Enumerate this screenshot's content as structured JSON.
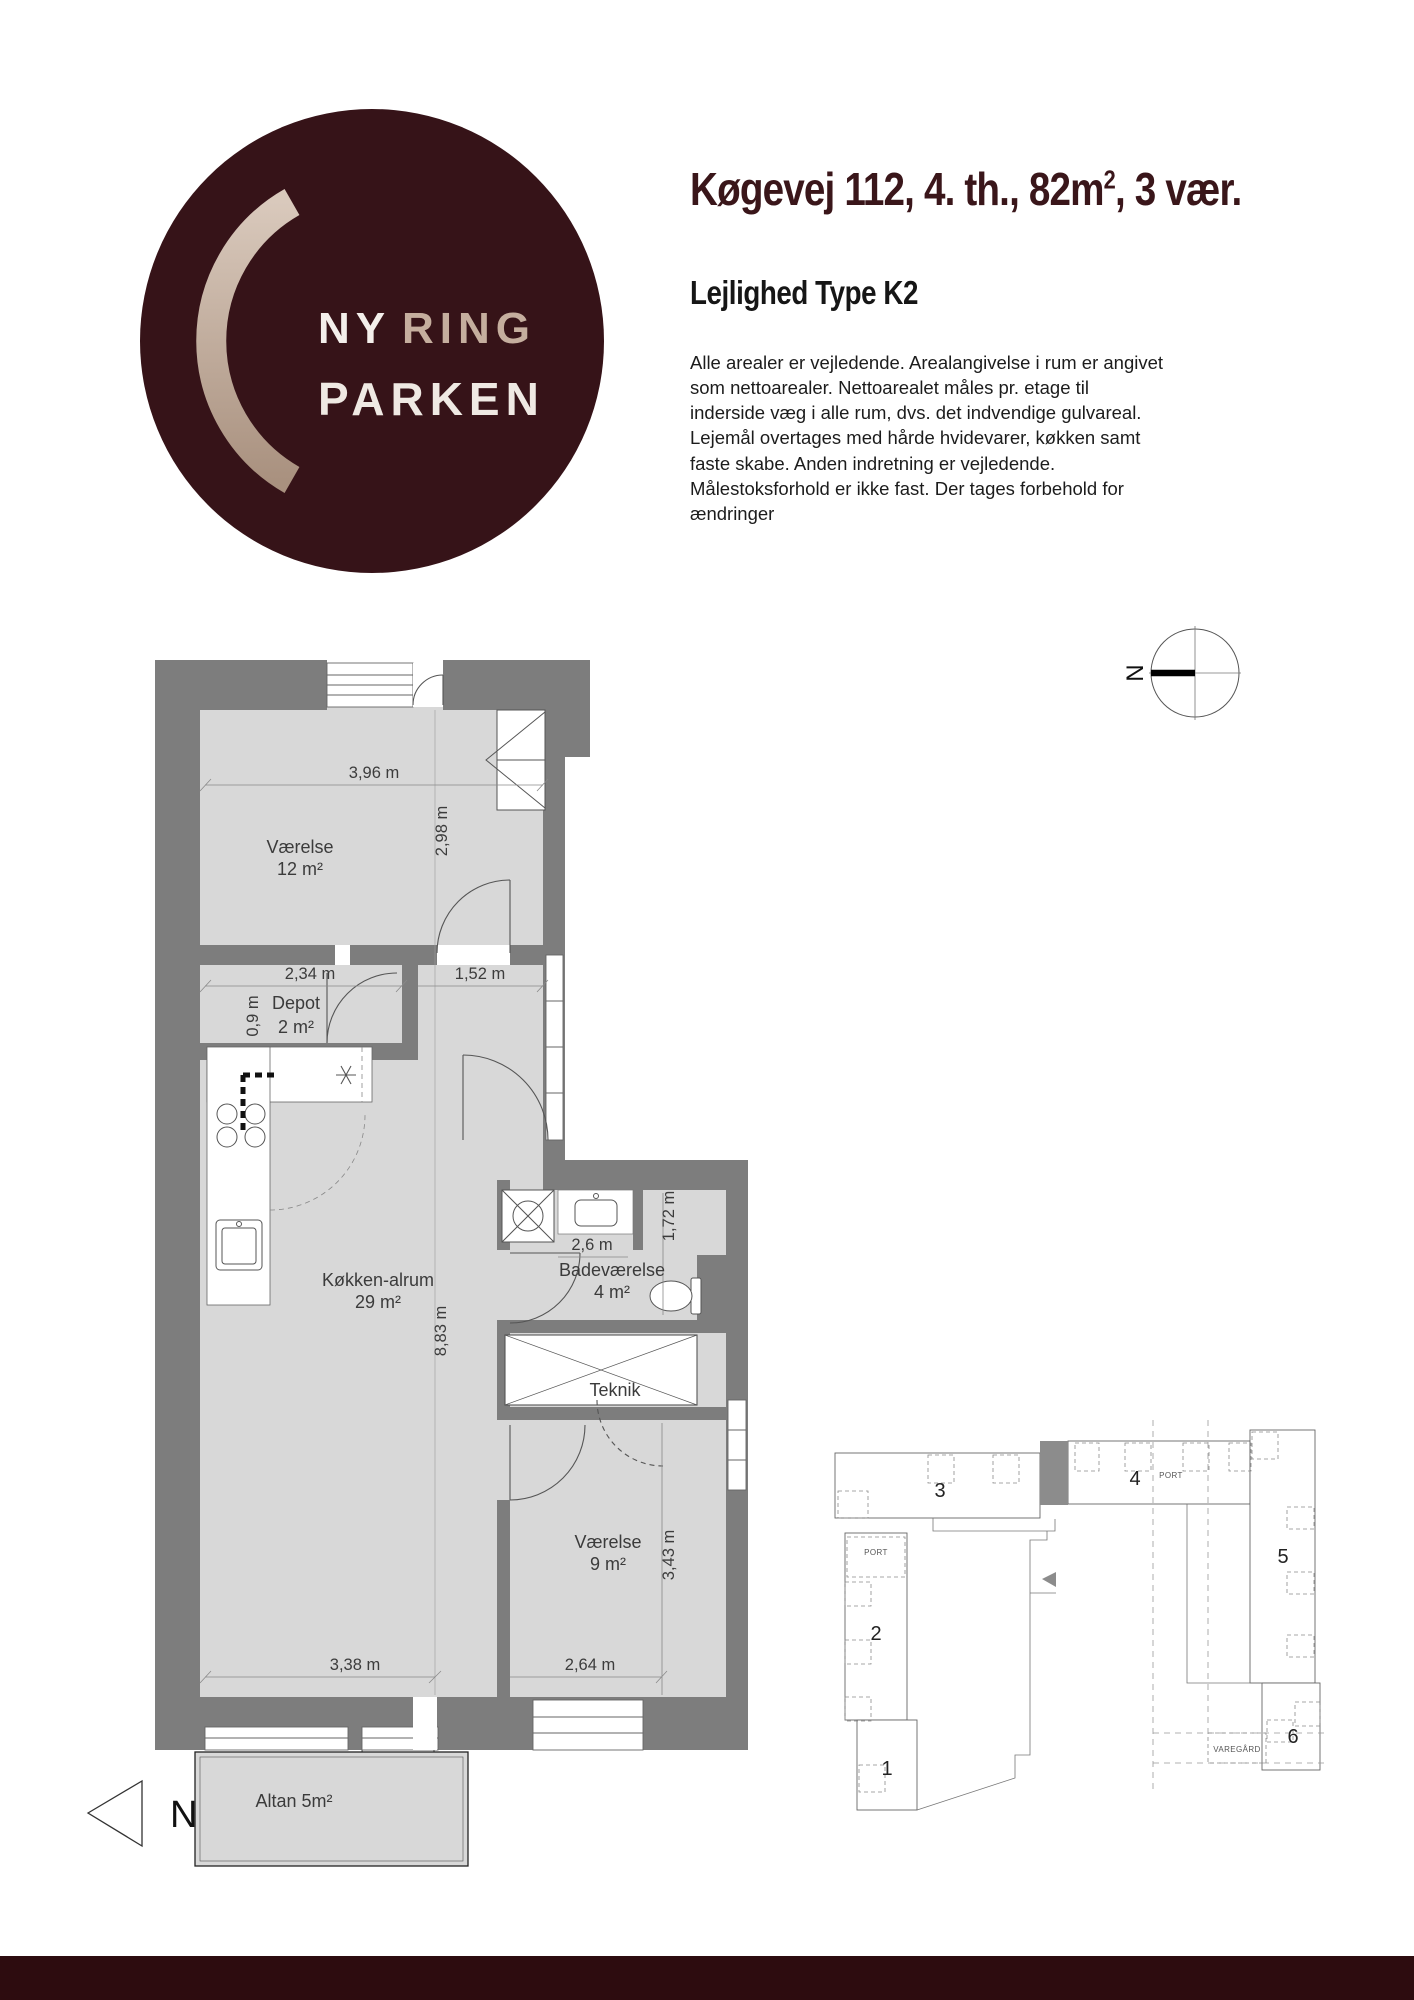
{
  "logo": {
    "word1": "NY",
    "word2": "RING",
    "word3": "PARKEN"
  },
  "header": {
    "title_main": "Køgevej 112, 4. th., 82m",
    "title_sup": "2",
    "title_tail": ", 3 vær.",
    "subtitle": "Lejlighed Type K2",
    "description_lines": [
      "Alle arealer er vejledende. Arealangivelse i rum er angivet",
      "som nettoarealer. Nettoarealet måles pr. etage til",
      "inderside væg i alle rum, dvs. det indvendige gulvareal.",
      "Lejemål overtages med hårde hvidevarer, køkken samt",
      "faste skabe. Anden indretning er vejledende.",
      "Målestoksforhold er ikke fast. Der tages forbehold for",
      "ændringer"
    ],
    "description": "Alle arealer er vejledende. Arealangivelse i rum er angivet som nettoarealer. Nettoarealet måles pr. etage til inderside væg i alle rum, dvs. det indvendige gulvareal. Lejemål overtages med hårde hvidevarer, køkken samt faste skabe. Anden indretning er vejledende. Målestoksforhold er ikke fast. Der tages forbehold for ændringer"
  },
  "compass": {
    "north": "N"
  },
  "floorplan": {
    "rooms": {
      "vaerelse12": {
        "name": "Værelse",
        "area": "12 m²"
      },
      "depot": {
        "name": "Depot",
        "area": "2 m²"
      },
      "koekken": {
        "name": "Køkken-alrum",
        "area": "29 m²"
      },
      "bad": {
        "name": "Badeværelse",
        "area": "4 m²"
      },
      "teknik": {
        "name": "Teknik"
      },
      "vaerelse9": {
        "name": "Værelse",
        "area": "9 m²"
      },
      "altan": {
        "name": "Altan 5m²"
      }
    },
    "dims": {
      "d396": "3,96 m",
      "d298": "2,98 m",
      "d234": "2,34 m",
      "d152": "1,52 m",
      "d09": "0,9 m",
      "d883": "8,83 m",
      "d26": "2,6 m",
      "d172": "1,72 m",
      "d343": "3,43 m",
      "d338": "3,38 m",
      "d264": "2,64 m"
    },
    "north": "N"
  },
  "siteplan": {
    "b1": "1",
    "b2": "2",
    "b3": "3",
    "b4": "4",
    "b5": "5",
    "b6": "6",
    "port": "PORT",
    "varegaard": "VAREGÅRD"
  },
  "colors": {
    "maroon": "#3a161a",
    "footer": "#2d0c0f",
    "beige": "#c5ae9e",
    "wall": "#7d7d7d",
    "floor": "#d8d8d8",
    "marker": "#8c8c8c"
  }
}
